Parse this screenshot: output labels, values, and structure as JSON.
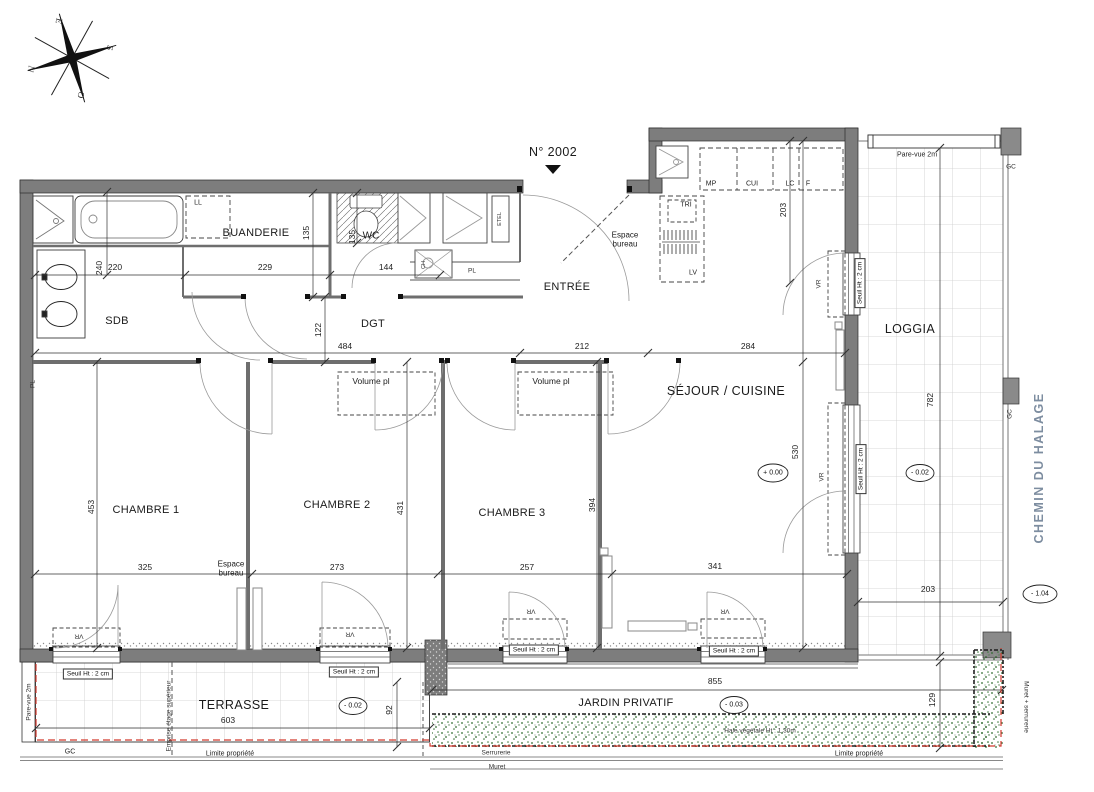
{
  "unit": {
    "number": "N° 2002"
  },
  "street": {
    "name": "CHEMIN DU HALAGE"
  },
  "compass": {
    "e": "E",
    "s": "S",
    "n": "N",
    "o": "O"
  },
  "rooms": {
    "sdb": "SDB",
    "buanderie": "BUANDERIE",
    "dgt": "DGT",
    "entree": "ENTRÉE",
    "sejour": "SÉJOUR / CUISINE",
    "loggia": "LOGGIA",
    "ch1": "CHAMBRE 1",
    "ch2": "CHAMBRE 2",
    "ch3": "CHAMBRE 3",
    "terrasse": "TERRASSE",
    "jardin": "JARDIN PRIVATIF",
    "espace_bureau": "Espace bureau"
  },
  "labels": {
    "pare_vue": "Pare-vue 2m",
    "gc": "GC",
    "seuil": "Seuil Ht : 2 cm",
    "vr": "VR",
    "volume_pl": "Volume pl",
    "etel": "ETEL",
    "pl": "PL",
    "ll": "LL",
    "lv": "LV",
    "tri": "TRI",
    "mp": "MP",
    "cui": "CUI",
    "lc": "LC",
    "f": "F",
    "ch": "CH",
    "wc": "WC",
    "limite": "Limite propriété",
    "serrurerie": "Serrurerie",
    "muret": "Muret",
    "muret_serrurerie": "Muret + serrurerie",
    "emprise": "Emprise étage supérieur",
    "haie": "Haie végétale Ht : 1.30m"
  },
  "levels": {
    "sejour": "+ 0.00",
    "loggia": "- 0.02",
    "terrasse": "- 0.02",
    "jardin": "- 0.03",
    "chemin": "- 1.04"
  },
  "dims": {
    "sdb_w": "220",
    "buanderie_w": "229",
    "wc_w": "144",
    "sdb_d": "240",
    "buanderie_h": "135",
    "wc_h": "135",
    "dgt_h": "122",
    "couloir_w": "484",
    "entree_w": "212",
    "sejour_w": "284",
    "cuisine_h": "203",
    "sejour_h": "530",
    "ch1_h": "453",
    "ch2_h": "431",
    "ch3_h": "394",
    "ch1_w": "325",
    "ch2_w": "273",
    "ch3_w": "257",
    "sejour_b": "341",
    "terrasse_w": "603",
    "terrasse_d": "92",
    "jardin_w": "855",
    "jardin_d": "129",
    "loggia_w": "203",
    "loggia_h": "782"
  },
  "colors": {
    "wall": "#7d7d7d",
    "property_line": "#d23a2e",
    "hedge": "#2f6b2f",
    "street_text": "#7d8da0"
  }
}
